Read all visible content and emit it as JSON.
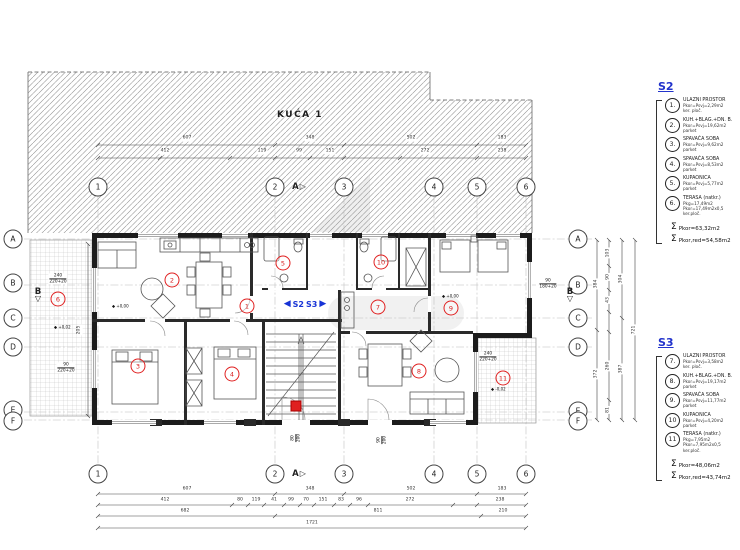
{
  "drawing": {
    "building_label": "KUĆA 1",
    "divider_left": "S2",
    "divider_right": "S3"
  },
  "symbols": {
    "level": "◆",
    "sum": "Σ",
    "arrow_left": "◀",
    "arrow_right": "▶",
    "tri_right": "▷",
    "tri_down": "▽"
  },
  "grid": {
    "cols": [
      "1",
      "2",
      "3",
      "4",
      "5",
      "6"
    ],
    "rows": [
      "A",
      "B",
      "C",
      "D",
      "E",
      "F"
    ],
    "section_a": "A",
    "section_b": "B"
  },
  "rooms": [
    "1",
    "2",
    "3",
    "4",
    "5",
    "6",
    "7",
    "8",
    "9",
    "10",
    "11"
  ],
  "levels": [
    "+0,00",
    "+0,02",
    "+0,00",
    "-0,02"
  ],
  "window_specs": [
    {
      "w": "240",
      "h": "220+20"
    },
    {
      "w": "90",
      "h": "180+20"
    },
    {
      "w": "240",
      "h": "220+20"
    },
    {
      "w": "90",
      "h": "220+20"
    },
    {
      "w": "80",
      "h": "200"
    },
    {
      "w": "90",
      "h": "200"
    }
  ],
  "dims": {
    "bottom_row1": [
      "607",
      "348",
      "502",
      "183"
    ],
    "bottom_row2": [
      "412",
      "80",
      "119",
      "41",
      "99",
      "70",
      "151",
      "83",
      "96",
      "272",
      "238"
    ],
    "bottom_row3": [
      "682",
      "811",
      "210"
    ],
    "bottom_total": "1721",
    "top_row1": [
      "607",
      "348",
      "502",
      "183"
    ],
    "top_row2": [
      "412",
      "119",
      "99",
      "151",
      "272",
      "238"
    ],
    "right_chain1": [
      "384",
      "372"
    ],
    "right_chain2": [
      "103",
      "90",
      "43",
      "260",
      "81"
    ],
    "right_chain3": [
      "304",
      "387"
    ],
    "right_total": "721",
    "left_inner": "205"
  },
  "legend": {
    "s2": {
      "title": "S2",
      "items": [
        {
          "num": "1.",
          "lines": [
            "ULAZNI PROSTOR",
            "Pkor=Psvj=2,29m2",
            "ker. ploč.",
            ""
          ]
        },
        {
          "num": "2.",
          "lines": [
            "KUH.+BLAG.+DN. B.",
            "Pkor=Psvj=19,62m2",
            "parket",
            ""
          ]
        },
        {
          "num": "3.",
          "lines": [
            "SPAVAĆA SOBA",
            "Pkor=Psvj=9,62m2",
            "parket",
            ""
          ]
        },
        {
          "num": "4.",
          "lines": [
            "SPAVAĆA SOBA",
            "Pkor=Psvj=8,53m2",
            "parket",
            ""
          ]
        },
        {
          "num": "5.",
          "lines": [
            "KUPAONICA",
            "Pkor=Psvj=5,77m2",
            "parket",
            ""
          ]
        },
        {
          "num": "6.",
          "lines": [
            "TERASA (natkr.)",
            "Pkg=17,49m2",
            "Pkor=17,49m2x0,5",
            "ker.ploč."
          ]
        }
      ],
      "sum1": "Pkor=63,32m2",
      "sum2": "Pkor,red=54,58m2"
    },
    "s3": {
      "title": "S3",
      "items": [
        {
          "num": "7.",
          "lines": [
            "ULAZNI PROSTOR",
            "Pkor=Psvj=3,58m2",
            "ker. ploč.",
            ""
          ]
        },
        {
          "num": "8.",
          "lines": [
            "KUH.+BLAG.+DN. B.",
            "Pkor=Psvj=19,17m2",
            "parket",
            ""
          ]
        },
        {
          "num": "9.",
          "lines": [
            "SPAVAĆA SOBA",
            "Pkor=Psvj=11,77m2",
            "parket",
            ""
          ]
        },
        {
          "num": "10",
          "lines": [
            "KUPAONICA",
            "Pkor=Psvj=4,20m2",
            "parket",
            ""
          ]
        },
        {
          "num": "11",
          "lines": [
            "TERASA (natkr.)",
            "Pkg=7,95m2",
            "Pkor=7,95m2x0,5",
            "ker.ploč."
          ]
        }
      ],
      "sum1": "Pkor=48,06m2",
      "sum2": "Pkor,red=43,74m2"
    }
  }
}
